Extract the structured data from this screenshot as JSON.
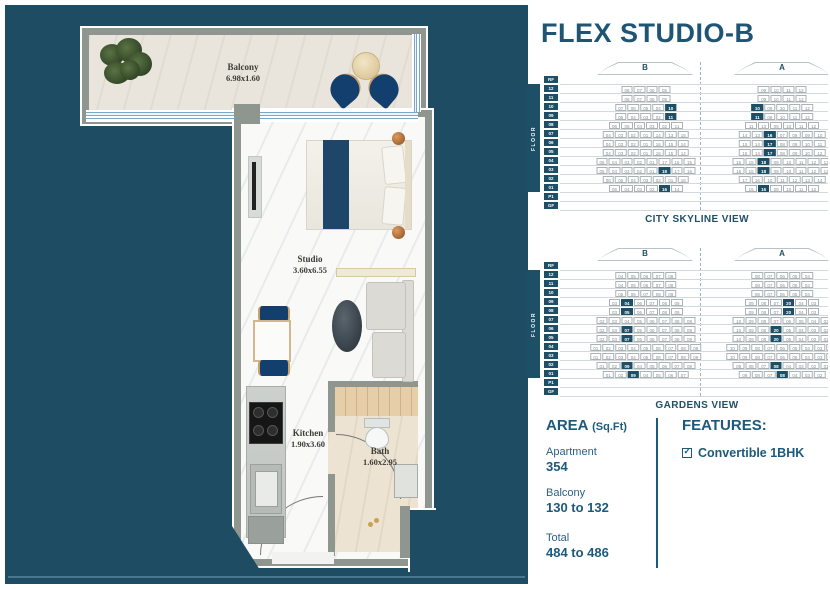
{
  "title": "FLEX STUDIO-B",
  "colors": {
    "panel": "#1e4c62",
    "accent": "#1e5574",
    "highlight": "#1d5066",
    "wall_gray": "#8e968f",
    "bed_blue": "#1d4668"
  },
  "floor_plan": {
    "rooms": {
      "balcony": {
        "name": "Balcony",
        "dim": "6.98x1.60"
      },
      "studio": {
        "name": "Studio",
        "dim": "3.60x6.55"
      },
      "kitchen": {
        "name": "Kitchen",
        "dim": "1.90x3.60"
      },
      "bath": {
        "name": "Bath",
        "dim": "1.60x2.95"
      }
    }
  },
  "diagrams": [
    {
      "caption": "CITY SKYLINE VIEW",
      "floor_axis_label": "FLOOR",
      "tower_labels": [
        "B",
        "A"
      ],
      "floors": [
        {
          "f": "RF",
          "b": [],
          "a": []
        },
        {
          "f": "12",
          "b": [
            "08",
            "07",
            "06",
            "05"
          ],
          "a": [
            "09",
            "10",
            "11",
            "12"
          ]
        },
        {
          "f": "11",
          "b": [
            "08",
            "07",
            "06",
            "05"
          ],
          "a": [
            "09",
            "10",
            "11",
            "12"
          ]
        },
        {
          "f": "10",
          "b": [
            "07",
            "06",
            "05",
            "04",
            "*10"
          ],
          "a": [
            "*10",
            "09",
            "10",
            "11",
            "12"
          ]
        },
        {
          "f": "09",
          "b": [
            "05",
            "04",
            "03",
            "02",
            "*11"
          ],
          "a": [
            "*11",
            "09",
            "10",
            "11",
            "12"
          ]
        },
        {
          "f": "08",
          "b": [
            "06",
            "05",
            "04",
            "03",
            "02",
            "11"
          ],
          "a": [
            "11",
            "13",
            "09",
            "10",
            "11",
            "12"
          ]
        },
        {
          "f": "07",
          "b": [
            "04",
            "03",
            "02",
            "01",
            "14",
            "13",
            "15"
          ],
          "a": [
            "14",
            "13",
            "*16",
            "07",
            "08",
            "09",
            "10"
          ]
        },
        {
          "f": "06",
          "b": [
            "04",
            "03",
            "02",
            "01",
            "16",
            "15",
            "14"
          ],
          "a": [
            "15",
            "14",
            "*17",
            "08",
            "09",
            "10",
            "11"
          ]
        },
        {
          "f": "05",
          "b": [
            "04",
            "03",
            "02",
            "01",
            "16",
            "15",
            "14"
          ],
          "a": [
            "15",
            "14",
            "*17",
            "08",
            "09",
            "10",
            "12"
          ]
        },
        {
          "f": "04",
          "b": [
            "05",
            "04",
            "03",
            "02",
            "01",
            "17",
            "16",
            "15"
          ],
          "a": [
            "16",
            "15",
            "*18",
            "09",
            "10",
            "11",
            "12",
            "13"
          ]
        },
        {
          "f": "03",
          "b": [
            "05",
            "04",
            "03",
            "02",
            "01",
            "*18",
            "17",
            "16"
          ],
          "a": [
            "16",
            "15",
            "*18",
            "09",
            "10",
            "11",
            "12",
            "13"
          ]
        },
        {
          "f": "02",
          "b": [
            "06",
            "05",
            "04",
            "03",
            "02",
            "01",
            "18"
          ],
          "a": [
            "17",
            "16",
            "10",
            "11",
            "12",
            "13",
            "14"
          ]
        },
        {
          "f": "01",
          "b": [
            "05",
            "04",
            "03",
            "02",
            "*16",
            "14"
          ],
          "a": [
            "15",
            "*16",
            "09",
            "10",
            "11",
            "12"
          ]
        },
        {
          "f": "P1",
          "b": [],
          "a": []
        },
        {
          "f": "GF",
          "b": [],
          "a": []
        }
      ]
    },
    {
      "caption": "GARDENS VIEW",
      "floor_axis_label": "FLOOR",
      "tower_labels": [
        "B",
        "A"
      ],
      "floors": [
        {
          "f": "RF",
          "b": [],
          "a": []
        },
        {
          "f": "12",
          "b": [
            "04",
            "05",
            "06",
            "07",
            "08"
          ],
          "a": [
            "08",
            "07",
            "06",
            "05",
            "04"
          ]
        },
        {
          "f": "11",
          "b": [
            "04",
            "05",
            "06",
            "07",
            "08"
          ],
          "a": [
            "08",
            "07",
            "06",
            "05",
            "04"
          ]
        },
        {
          "f": "10",
          "b": [
            "05",
            "06",
            "07",
            "08",
            "09"
          ],
          "a": [
            "08",
            "07",
            "06",
            "05",
            "04"
          ]
        },
        {
          "f": "09",
          "b": [
            "03",
            "*04",
            "06",
            "07",
            "08",
            "09"
          ],
          "a": [
            "09",
            "08",
            "07",
            "*20",
            "04",
            "03"
          ]
        },
        {
          "f": "08",
          "b": [
            "03",
            "*05",
            "06",
            "07",
            "08",
            "09"
          ],
          "a": [
            "09",
            "08",
            "07",
            "*20",
            "04",
            "03"
          ]
        },
        {
          "f": "07",
          "b": [
            "02",
            "03",
            "04",
            "05",
            "06",
            "07",
            "08",
            "09"
          ],
          "a": [
            "10",
            "09",
            "08",
            "07",
            "06",
            "05",
            "04",
            "03"
          ]
        },
        {
          "f": "06",
          "b": [
            "02",
            "03",
            "*07",
            "05",
            "06",
            "07",
            "08",
            "09"
          ],
          "a": [
            "10",
            "09",
            "08",
            "*20",
            "05",
            "04",
            "03",
            "02"
          ]
        },
        {
          "f": "05",
          "b": [
            "02",
            "03",
            "*07",
            "05",
            "06",
            "07",
            "08",
            "09"
          ],
          "a": [
            "10",
            "09",
            "08",
            "*20",
            "05",
            "04",
            "03",
            "02"
          ]
        },
        {
          "f": "04",
          "b": [
            "01",
            "02",
            "03",
            "04",
            "05",
            "06",
            "07",
            "08",
            "09"
          ],
          "a": [
            "10",
            "09",
            "08",
            "07",
            "06",
            "05",
            "04",
            "03",
            "02"
          ]
        },
        {
          "f": "03",
          "b": [
            "01",
            "02",
            "03",
            "04",
            "05",
            "06",
            "07",
            "08",
            "09"
          ],
          "a": [
            "10",
            "09",
            "08",
            "07",
            "06",
            "05",
            "04",
            "03",
            "02"
          ]
        },
        {
          "f": "02",
          "b": [
            "01",
            "02",
            "*09",
            "04",
            "05",
            "06",
            "07",
            "08"
          ],
          "a": [
            "09",
            "08",
            "07",
            "*08",
            "04",
            "03",
            "02",
            "01"
          ]
        },
        {
          "f": "01",
          "b": [
            "01",
            "02",
            "*09",
            "04",
            "05",
            "06",
            "07"
          ],
          "a": [
            "09",
            "08",
            "07",
            "*08",
            "04",
            "03",
            "02"
          ]
        },
        {
          "f": "P1",
          "b": [],
          "a": []
        },
        {
          "f": "GF",
          "b": [],
          "a": []
        }
      ]
    }
  ],
  "area": {
    "heading": "AREA",
    "heading_unit": "(Sq.Ft)",
    "items": [
      {
        "label": "Apartment",
        "value": "354"
      },
      {
        "label": "Balcony",
        "value": "130 to 132"
      },
      {
        "label": "Total",
        "value": "484 to 486"
      }
    ]
  },
  "features": {
    "heading": "FEATURES:",
    "items": [
      {
        "checked": true,
        "label": "Convertible 1BHK"
      }
    ]
  }
}
